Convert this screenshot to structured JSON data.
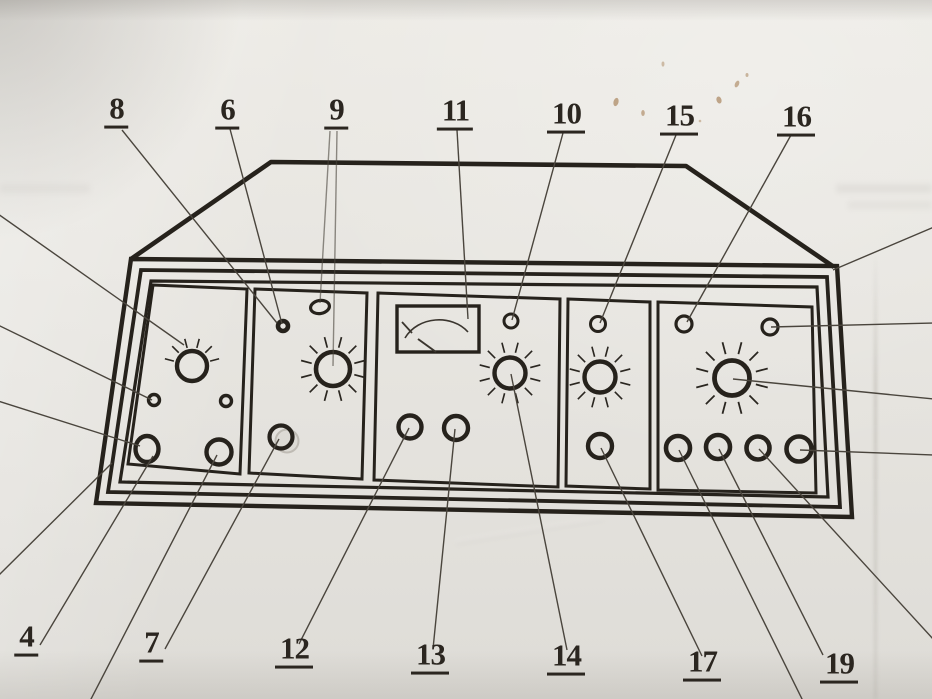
{
  "document": {
    "description": "Scanned technical line drawing of an instrument front panel with numbered callout leader lines",
    "paper_color": "#e8e6e1",
    "ink_color": "#26221c",
    "leader_color": "#4a453d",
    "stain_color": "#8e5c26"
  },
  "callouts": {
    "top": [
      {
        "text": "8"
      },
      {
        "text": "6"
      },
      {
        "text": "9"
      },
      {
        "text": "11"
      },
      {
        "text": "10"
      },
      {
        "text": "15"
      },
      {
        "text": "16"
      }
    ],
    "bottom": [
      {
        "text": "4"
      },
      {
        "text": "7"
      },
      {
        "text": "12"
      },
      {
        "text": "13"
      },
      {
        "text": "14"
      },
      {
        "text": "17"
      },
      {
        "text": "19"
      }
    ]
  },
  "panel": {
    "sections": [
      {
        "components": [
          "rotary-knob-with-rays",
          "small-indicator",
          "small-indicator",
          "round-socket",
          "round-socket"
        ]
      },
      {
        "components": [
          "small-dot-indicator",
          "small-oval-indicator",
          "rotary-knob-with-rays",
          "round-socket"
        ]
      },
      {
        "components": [
          "meter-window",
          "small-indicator",
          "rotary-knob-with-rays",
          "round-socket",
          "round-socket"
        ]
      },
      {
        "components": [
          "small-indicator",
          "rotary-knob-with-rays",
          "round-socket"
        ]
      },
      {
        "components": [
          "small-indicator",
          "small-indicator",
          "rotary-knob-with-rays",
          "round-socket",
          "round-socket",
          "round-socket",
          "round-socket"
        ]
      }
    ]
  }
}
